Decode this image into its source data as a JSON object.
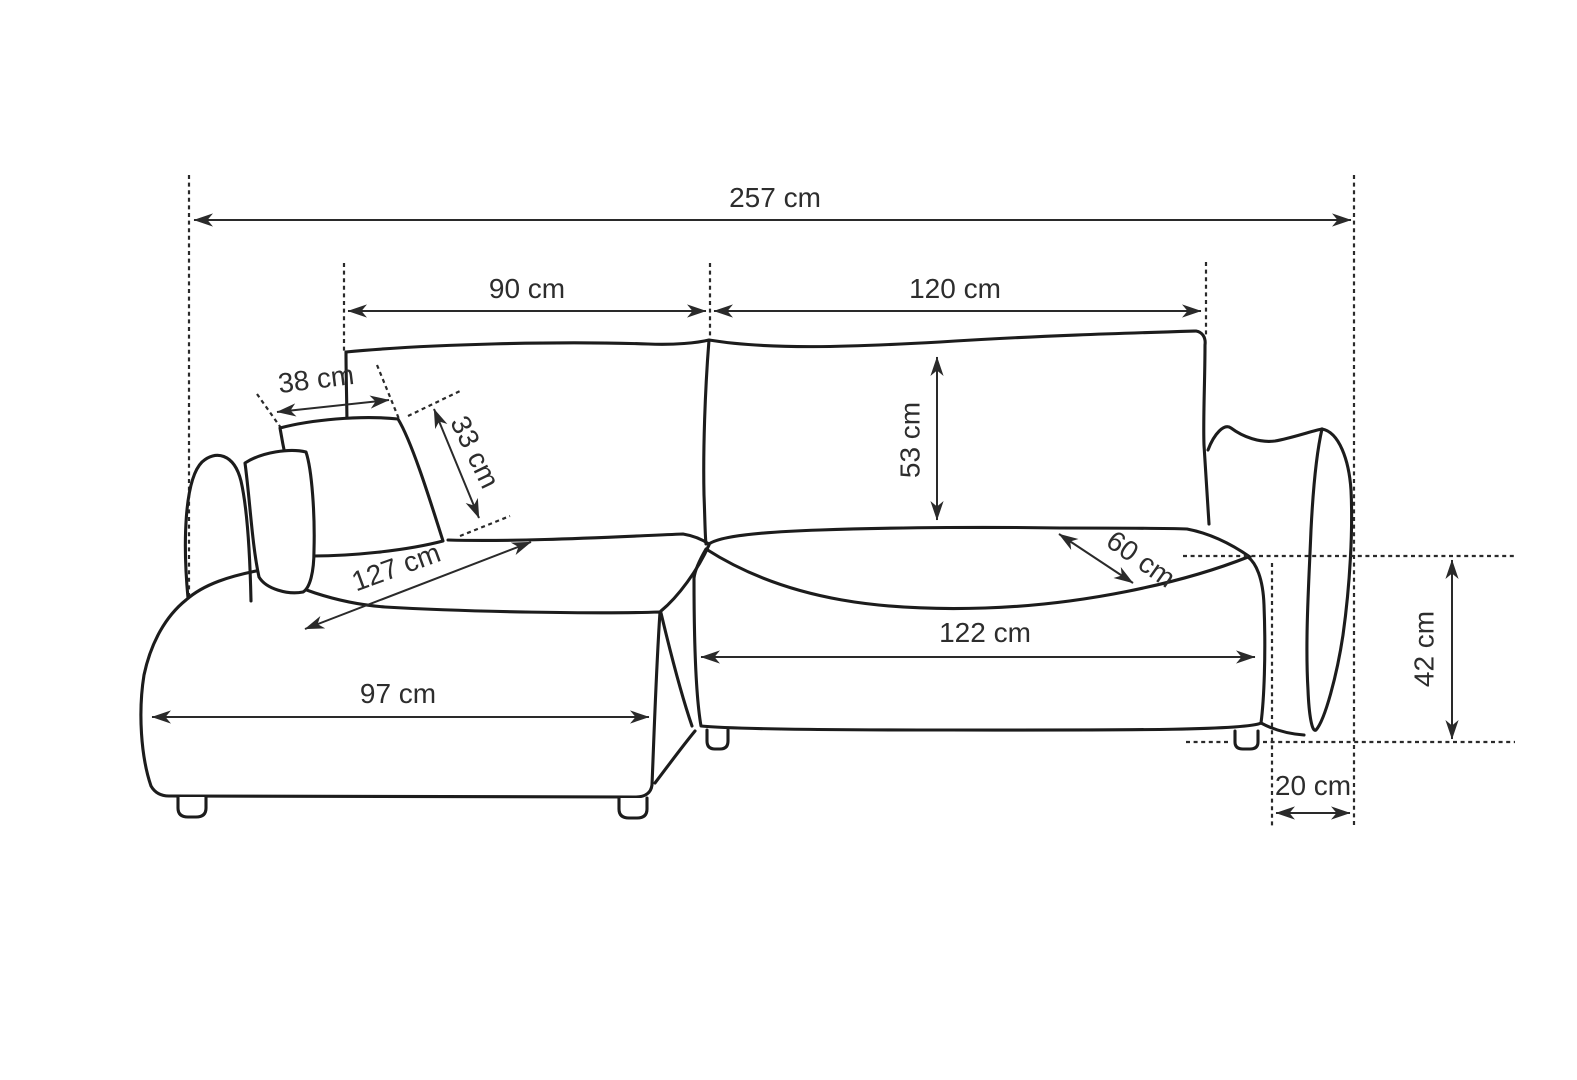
{
  "page": {
    "background": "#ffffff",
    "ink_color": "#1c1c1c",
    "label_color": "#2d2d2d"
  },
  "diagram": {
    "type": "furniture-dimension-drawing",
    "subject": "corner sofa with chaise longue, hand-drawn technical sketch with dimension arrows",
    "unit": "cm",
    "dims": {
      "overall_width": {
        "label": "257 cm",
        "value": 257
      },
      "back_left_width": {
        "label": "90 cm",
        "value": 90
      },
      "back_right_width": {
        "label": "120 cm",
        "value": 120
      },
      "cushion_width": {
        "label": "38 cm",
        "value": 38
      },
      "cushion_depth": {
        "label": "33 cm",
        "value": 33
      },
      "backrest_height": {
        "label": "53 cm",
        "value": 53
      },
      "chaise_length": {
        "label": "127 cm",
        "value": 127
      },
      "seat_depth": {
        "label": "60 cm",
        "value": 60
      },
      "chaise_front_width": {
        "label": "97 cm",
        "value": 97
      },
      "seat_front_width": {
        "label": "122 cm",
        "value": 122
      },
      "armrest_height": {
        "label": "42 cm",
        "value": 42
      },
      "armrest_depth": {
        "label": "20 cm",
        "value": 20
      }
    }
  }
}
